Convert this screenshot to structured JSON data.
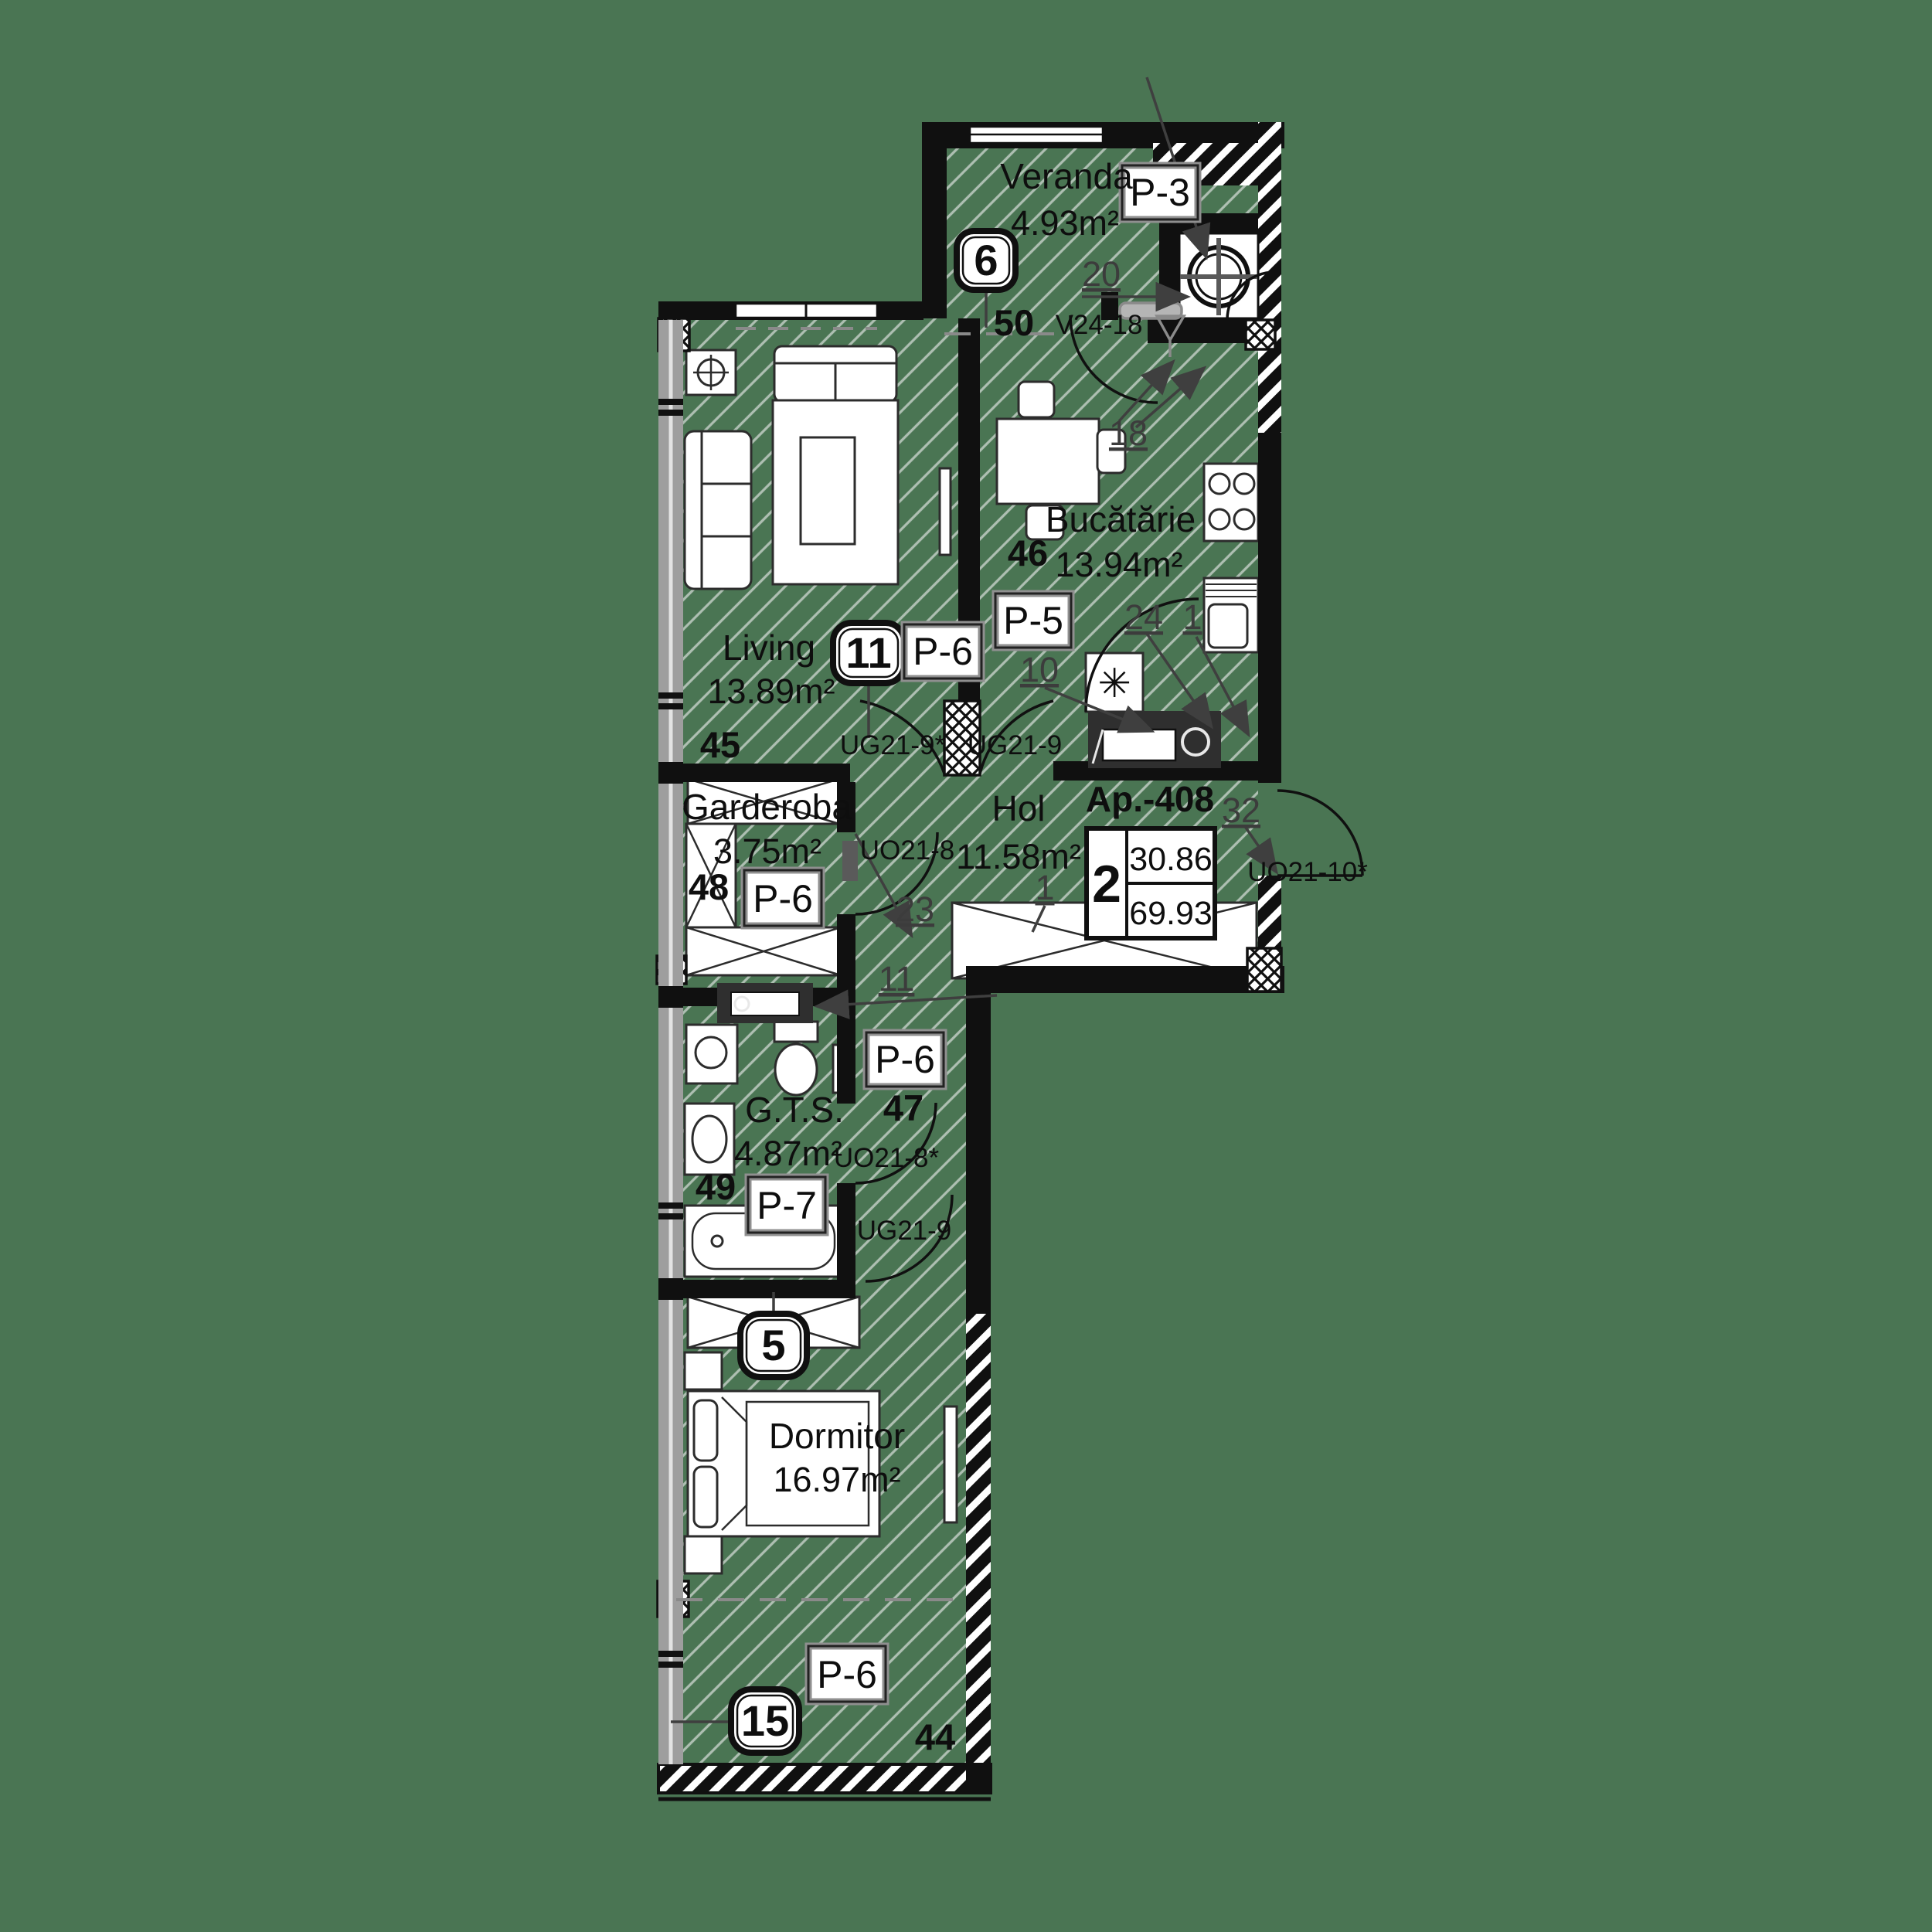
{
  "colors": {
    "background": "#4a7553",
    "wall": "#111111",
    "hatch_line": "#aebfb2",
    "window_band": "#9e9e9e"
  },
  "apartment": {
    "title": "Ap.-408",
    "summary": {
      "rooms": "2",
      "living_area": "30.86",
      "total_area": "69.93"
    },
    "rooms": {
      "veranda": {
        "name": "Veranda",
        "area": "4.93m²",
        "badge": "6",
        "number": "50",
        "panel": "P-3",
        "window_code": "V24-18",
        "ref_dim": "20",
        "ref_door": "18"
      },
      "bucatarie": {
        "name": "Bucătărie",
        "area": "13.94m²",
        "number": "46",
        "panel": "P-5",
        "ref_a": "24",
        "ref_b": "1",
        "ref_c": "10"
      },
      "living": {
        "name": "Living",
        "area": "13.89m²",
        "number": "45",
        "badge": "11",
        "panel": "P-6",
        "door_to_hol": "UG21-9*",
        "door_to_kitchen": "UG21-9"
      },
      "garderoba": {
        "name": "Garderoba",
        "area": "3.75m²",
        "number": "48",
        "panel": "P-6",
        "door": "UO21-8",
        "ref_door": "23"
      },
      "hol": {
        "name": "Hol",
        "area": "11.58m²",
        "entry_ref": "32",
        "entry_door": "UO21-10*",
        "wardrobe_ref": "1",
        "ref_wm": "11"
      },
      "gts": {
        "name": "G.T.S.",
        "area": "4.87m²",
        "number": "49",
        "panel": "P-7",
        "door": "UO21-8*"
      },
      "corridor": {
        "number": "47",
        "panel": "P-6",
        "door": "UG21-9"
      },
      "dormitor": {
        "name": "Dormitor",
        "area": "16.97m²",
        "badge": "5"
      },
      "balcon": {
        "number": "44",
        "panel": "P-6",
        "badge": "15"
      }
    }
  },
  "symbols": {
    "fridge": "✳"
  }
}
